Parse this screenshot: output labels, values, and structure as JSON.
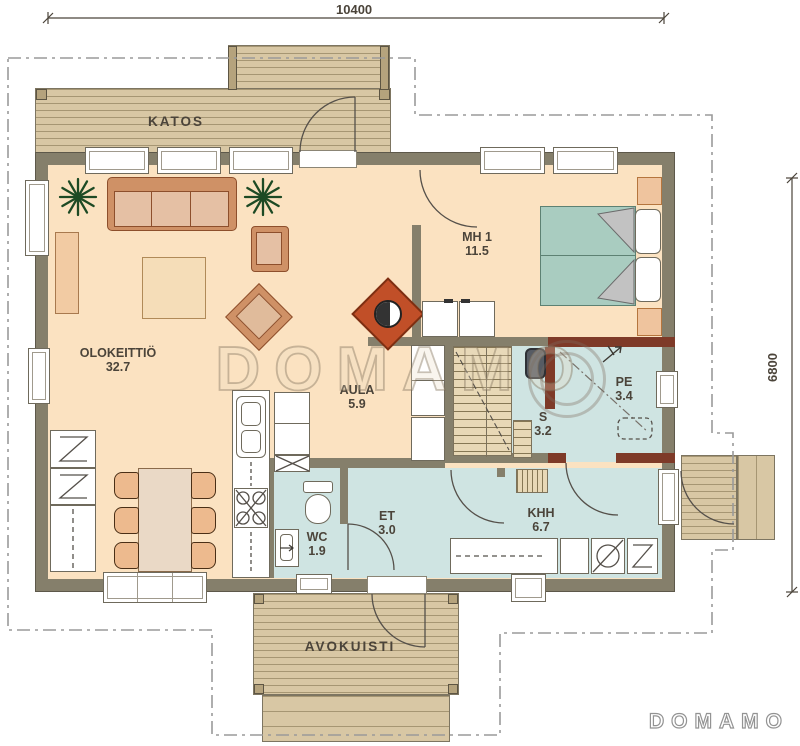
{
  "plan_title": "House floor plan",
  "dimensions": {
    "top": "10400",
    "right": "6800"
  },
  "rooms": {
    "katos": {
      "name": "KATOS"
    },
    "olokeittio": {
      "name": "OLOKEITTIÖ",
      "area": "32.7"
    },
    "mh1": {
      "name": "MH 1",
      "area": "11.5"
    },
    "aula": {
      "name": "AULA",
      "area": "5.9"
    },
    "pe": {
      "name": "PE",
      "area": "3.4"
    },
    "s": {
      "name": "S",
      "area": "3.2"
    },
    "wc": {
      "name": "WC",
      "area": "1.9"
    },
    "et": {
      "name": "ET",
      "area": "3.0"
    },
    "khh": {
      "name": "KHH",
      "area": "6.7"
    },
    "avokuisti": {
      "name": "AVOKUISTI"
    }
  },
  "watermarks": {
    "center": "DOMAMO",
    "logo": "DOMAMO"
  },
  "icons": {
    "plant": "plant-icon",
    "fireplace": "fireplace-icon",
    "shower": "shower-icon",
    "stove": "stove-icon",
    "sink": "sink-icon",
    "toilet": "toilet-icon",
    "washer": "washing-machine-icon",
    "fridge": "fridge-freezer-icon",
    "sauna_heater": "sauna-heater-icon",
    "stairs": "stairs-icon",
    "bed": "double-bed-icon"
  },
  "colors": {
    "floor": "#fbe2c1",
    "wet_floor": "#cfe4e2",
    "wall": "#857f6b",
    "sauna_wall": "#7e3a28",
    "deck": "#d8c7a4",
    "fireplace": "#c14f28",
    "bed": "#a9ccc0",
    "furniture": "#e5c0a4",
    "plant": "#1d4a24"
  }
}
